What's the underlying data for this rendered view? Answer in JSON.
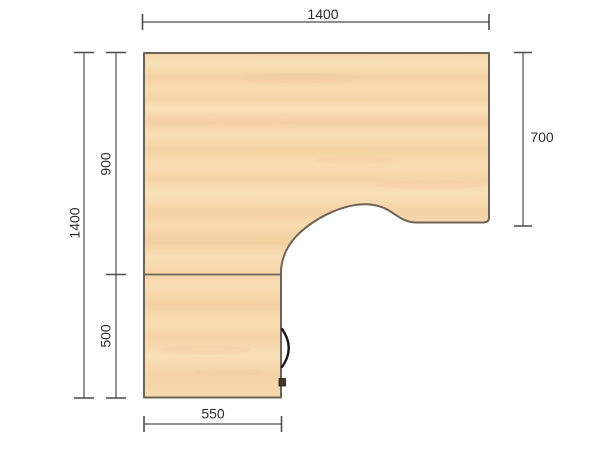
{
  "drawing": {
    "kind": "corner-desk-top-plan"
  },
  "dimensions": {
    "top_width_mm": "1400",
    "left_total_height_mm": "1400",
    "left_upper_section_mm": "900",
    "left_lower_section_mm": "500",
    "right_depth_mm": "700",
    "bottom_return_width_mm": "550"
  },
  "colors": {
    "background": "#ffffff",
    "wood_light": "#fae2ba",
    "wood_base": "#f7dbae",
    "wood_dark": "#f2d0a0",
    "wood_blush": "#f3c79e",
    "edge": "#6e6355",
    "dimension_line": "#4c4c4c",
    "dimension_text": "#2d2d2d",
    "swing_arc": "#1a1a1a",
    "hinge": "#46392a"
  }
}
